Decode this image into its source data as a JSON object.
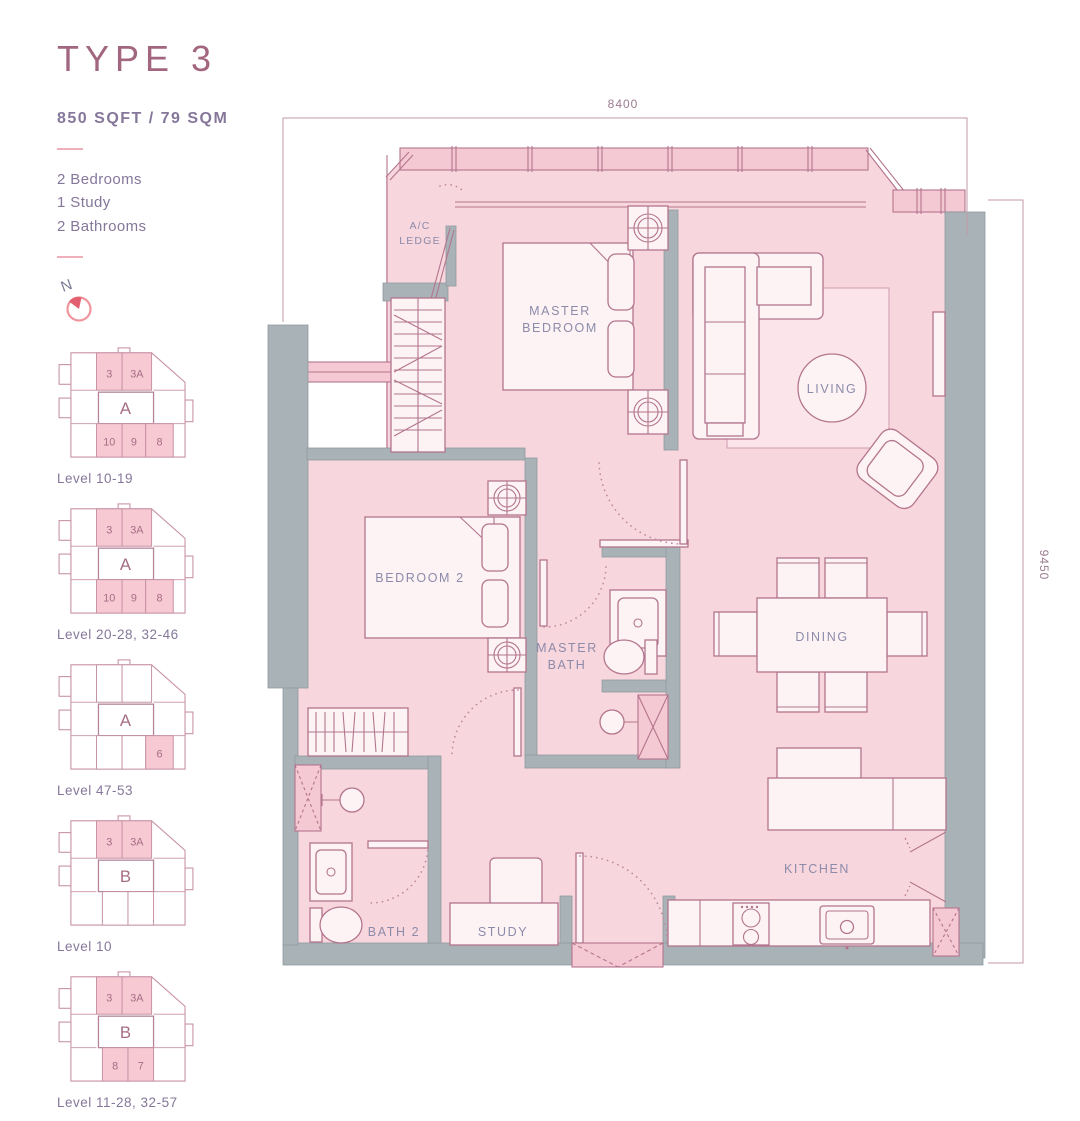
{
  "header": {
    "title": "TYPE 3",
    "area": "850 SQFT / 79 SQM",
    "features": [
      "2 Bedrooms",
      "1 Study",
      "2 Bathrooms"
    ]
  },
  "north": {
    "label": "N"
  },
  "keyplans": [
    {
      "label": "Level 10-19",
      "block": "A",
      "top": [
        "3",
        "3A"
      ],
      "bottom": [
        "10",
        "9",
        "8"
      ]
    },
    {
      "label": "Level 20-28, 32-46",
      "block": "A",
      "top": [
        "3",
        "3A"
      ],
      "bottom": [
        "10",
        "9",
        "8"
      ]
    },
    {
      "label": "Level 47-53",
      "block": "A",
      "top": [],
      "bottom": [
        "6"
      ]
    },
    {
      "label": "Level 10",
      "block": "B",
      "top": [
        "3",
        "3A"
      ],
      "bottom": []
    },
    {
      "label": "Level 11-28, 32-57",
      "block": "B",
      "top": [
        "3",
        "3A"
      ],
      "bottom": [
        "8",
        "7"
      ]
    }
  ],
  "floorplan": {
    "rooms": {
      "ac_ledge": [
        "A/C",
        "LEDGE"
      ],
      "master_bedroom": [
        "MASTER",
        "BEDROOM"
      ],
      "living": "LIVING",
      "bedroom2": "BEDROOM 2",
      "master_bath": [
        "MASTER",
        "BATH"
      ],
      "dining": "DINING",
      "bath2": "BATH 2",
      "study": "STUDY",
      "kitchen": "KITCHEN"
    },
    "dimensions": {
      "top": "8400",
      "right": "9450"
    }
  },
  "colors": {
    "title": "#a2677f",
    "body_text": "#85779a",
    "floor": "#f8d6dd",
    "wall": "#a9b2b6",
    "outline": "#b3758d",
    "room_label": "#8c8baa",
    "highlight": "#f7c9d3",
    "compass": "#e25f70"
  }
}
